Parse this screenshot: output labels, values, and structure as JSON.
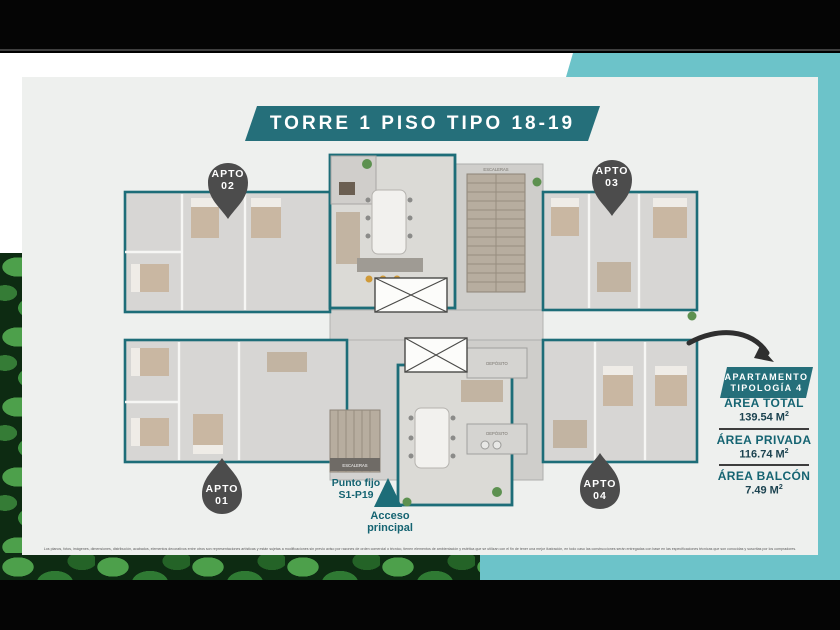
{
  "title": "TORRE 1 PISO TIPO 18-19",
  "apartments": [
    {
      "name": "APTO",
      "number": "01",
      "pin_direction": "up"
    },
    {
      "name": "APTO",
      "number": "02",
      "pin_direction": "down"
    },
    {
      "name": "APTO",
      "number": "03",
      "pin_direction": "down"
    },
    {
      "name": "APTO",
      "number": "04",
      "pin_direction": "up"
    }
  ],
  "info_panel": {
    "heading_line1": "APARTAMENTO",
    "heading_line2": "TIPOLOGÍA 4",
    "areas": [
      {
        "label": "ÁREA TOTAL",
        "value": "139.54 M",
        "sup": "2"
      },
      {
        "label": "ÁREA PRIVADA",
        "value": "116.74 M",
        "sup": "2"
      },
      {
        "label": "ÁREA BALCÓN",
        "value": "7.49 M",
        "sup": "2"
      }
    ]
  },
  "annotations": {
    "punto_fijo_line1": "Punto fijo",
    "punto_fijo_line2": "S1-P19",
    "acceso_line1": "Acceso",
    "acceso_line2": "principal"
  },
  "plan_labels": {
    "escaleras": "ESCALERAS",
    "deposito": "DEPÓSITO"
  },
  "disclaimer": "Los planos, fotos, imágenes, dimensiones, distribución, acabados, elementos decorativos entre otros son representaciones artísticas y están sujetas a modificaciones sin previo aviso por razones de orden comercial o técnico, tienen elementos de ambientación y estética que se utilizan con el fin de tener una mejor ilustración, en todo caso las construcciones serán entregadas con base en las especificaciones técnicas que son conocidas y suscritas por los compradores.",
  "colors": {
    "banner_teal": "#256f7a",
    "accent_teal": "#6cc3c9",
    "plan_outline_teal": "#1d6d78",
    "pin_gray": "#4c4c4c",
    "label_teal": "#156472",
    "value_dark": "#1c4350",
    "card_background": "#eef0ee",
    "letterbox_black": "#050505"
  }
}
